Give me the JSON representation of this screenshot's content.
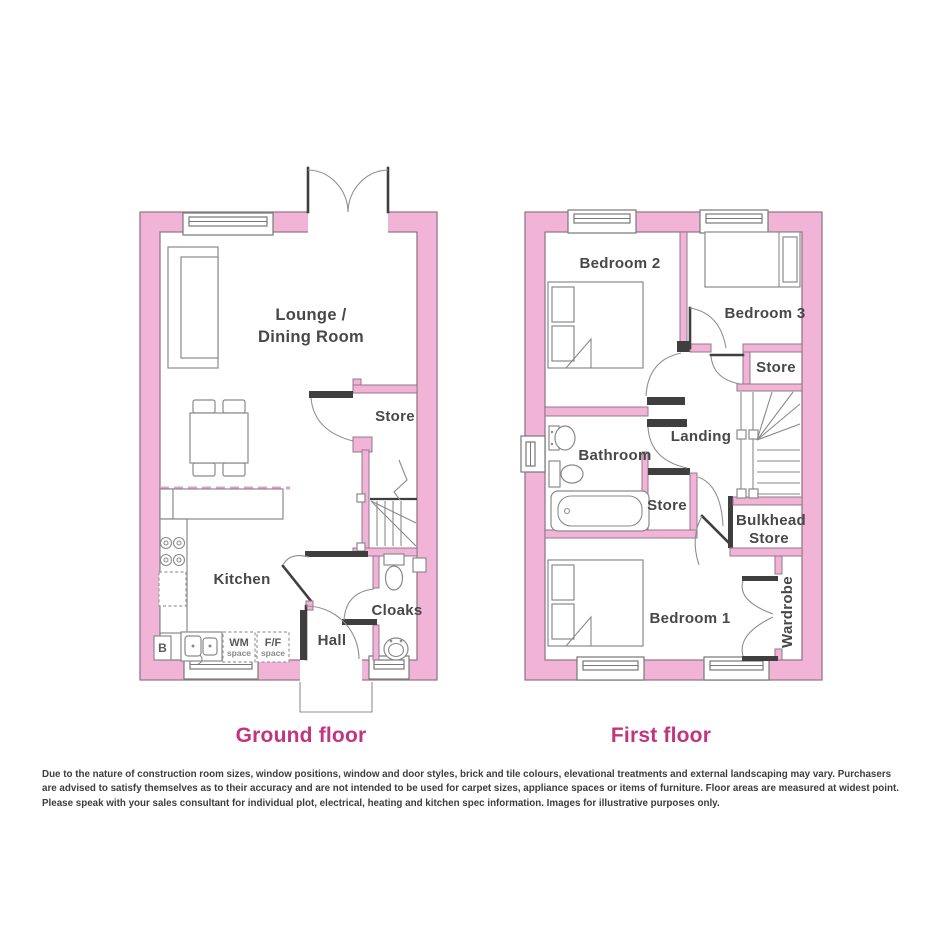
{
  "titles": {
    "ground": "Ground floor",
    "first": "First floor"
  },
  "disclaimer": "Due to the nature of construction room sizes, window positions, window and door styles, brick and tile colours, elevational treatments and external landscaping may vary. Purchasers are advised to satisfy themselves as to their accuracy and are not intended to be used for carpet sizes, appliance spaces or items of furniture. Floor areas are measured at widest point. Please speak with your sales consultant for individual plot, electrical, heating and kitchen spec information. Images for illustrative purposes only.",
  "ground": {
    "lounge1": "Lounge /",
    "lounge2": "Dining Room",
    "store": "Store",
    "kitchen": "Kitchen",
    "hall": "Hall",
    "cloaks": "Cloaks",
    "wm1": "WM",
    "wm2": "space",
    "ff1": "F/F",
    "ff2": "space",
    "boiler": "B"
  },
  "first": {
    "bedroom2": "Bedroom 2",
    "bedroom3": "Bedroom 3",
    "store_upper": "Store",
    "landing": "Landing",
    "bathroom": "Bathroom",
    "store_mid": "Store",
    "bulkhead1": "Bulkhead",
    "bulkhead2": "Store",
    "bedroom1": "Bedroom 1",
    "wardrobe": "Wardrobe"
  },
  "colors": {
    "wall_fill": "#F1B4D6",
    "wall_outline": "#93788A",
    "accent": "#C23480",
    "label": "#484848",
    "furniture_line": "#8a8a8a",
    "door_dark": "#3f3f3f",
    "background": "#ffffff"
  }
}
